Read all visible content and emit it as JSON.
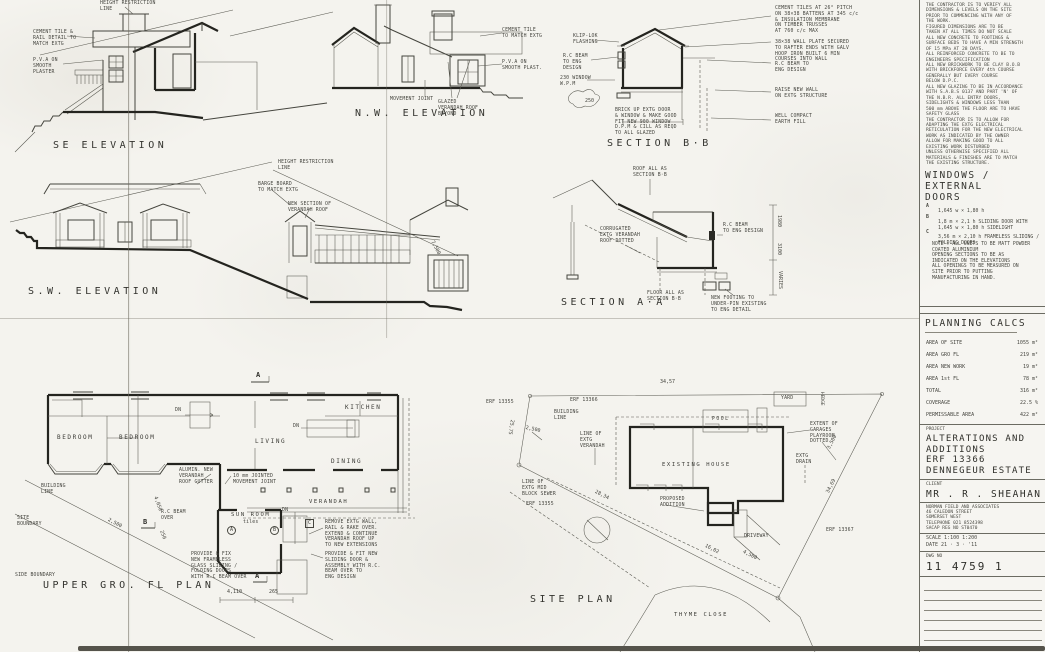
{
  "sheet": {
    "paper": "#f4f3ee",
    "ink": "#45453f"
  },
  "titleblock": {
    "notes": "THE CONTRACTOR IS TO VERIFY ALL\nDIMENSIONS & LEVELS ON THE SITE\nPRIOR TO COMMENCING WITH ANY OF\nTHE WORK.\nFIGURED DIMENSIONS ARE TO BE\nTAKEN AT ALL TIMES  DO NOT SCALE\nALL NEW CONCRETE TO FOOTINGS &\nSURFACE BEDS TO HAVE A MIN STRENGTH\nOF 15 MPa AT 28 DAYS.\nALL REINFORCED CONCRETE TO BE TO\nENGINEERS SPECIFICATION\nALL NEW BRICKWORK TO BE CLAY B.O.B\nWITH BRICKFORCE EVERY 4th COURSE\nGENERALLY BUT EVERY COURSE\nBELOW D.P.C.\nALL NEW GLAZING TO BE IN ACCORDANCE\nWITH S.A.B.S 0137 AND PART 'N' OF\nTHE N.B.R.  ALL ENTRY DOORS,\nSIDELIGHTS & WINDOWS LESS THAN\n500 mm ABOVE THE FLOOR ARE TO HAVE\nSAFETY GLASS\nTHE CONTRACTOR IS TO ALLOW FOR\nADAPTING THE EXTG ELECTRICAL\nRETICULATION FOR THE NEW ELECTRICAL\nWORK AS INDICATED BY THE OWNER\nALLOW FOR MAKING GOOD TO ALL\nEXISTING WORK DISTURBED\nUNLESS OTHERWISE SPECIFIED ALL\nMATERIALS & FINISHES ARE TO MATCH\nTHE EXISTING STRUCTURE.",
    "windows": {
      "title": "WINDOWS / EXTERNAL\nDOORS",
      "items": [
        {
          "key": "A",
          "text": "1,645 w × 1,80 h"
        },
        {
          "key": "B",
          "text": "1,8 m × 2,1 h SLIDING DOOR WITH\n1,645 w × 1,80 h SIDELIGHT"
        },
        {
          "key": "C",
          "text": "3,56 m × 2,10 h FRAMELESS SLIDING /\nFOLDING DOORS"
        }
      ],
      "note": "NOTE : ALL UNITS TO BE MATT POWDER\nCOATED ALUMINIUM\nOPENING SECTIONS TO BE AS\nINDICATED ON THE ELEVATIONS\nALL OPENINGS TO BE MEASURED ON\nSITE PRIOR TO PUTTING\nMANUFACTURING IN HAND."
    },
    "planning": {
      "title": "PLANNING  CALCS",
      "rows": [
        [
          "AREA OF SITE",
          "1055 m²"
        ],
        [
          "AREA GRO FL",
          "219 m²"
        ],
        [
          "AREA NEW WORK",
          "19 m²"
        ],
        [
          "AREA 1st FL",
          "78 m²"
        ],
        [
          "TOTAL",
          "316 m²"
        ],
        [
          "COVERAGE",
          "22.5 %"
        ],
        [
          "PERMISSABLE AREA",
          "422 m²"
        ]
      ]
    },
    "project": {
      "label": "PROJECT",
      "name": "ALTERATIONS  AND\nADDITIONS\nERF  13366\nDENNEGEUR  ESTATE",
      "client_label": "CLIENT",
      "client": "MR . R . SHEAHAN",
      "firm": "NORMAN FIELD AND ASSOCIATES\n46 CALEDON STREET\nSOMERSET WEST\nTELEPHONE 021 8524398\nSACAP REG NO ST0470",
      "scale": "SCALE   1:100    1:200",
      "date": "DATE    21 · 3 · '11",
      "dwg_label": "DWG NO",
      "dwg_no": "11  4759 1"
    }
  },
  "se": {
    "label": "SE  ELEVATION",
    "height_note": "HEIGHT  RESTRICTION\nLINE",
    "tile_note": "CEMENT TILE &\nRAIL DETAIL TO\nMATCH EXTG",
    "plaster_note": "P.V.A ON\nSMOOTH\nPLASTER"
  },
  "nw": {
    "label": "N.W.  ELEVATION",
    "tile_note": "CEMENT TILE\nTO MATCH EXTG",
    "plaster_note": "P.V.A ON\nSMOOTH PLAST.",
    "joint_note": "MOVEMENT  JOINT",
    "verandah_note": "GLAZED\nVERANDAH ROOF\nBEYOND"
  },
  "sbb": {
    "label": "SECTION  B·B",
    "flashing": "KLIP-LOK\nFLASHING",
    "beam": "R.C BEAM\nTO ENG\nDESIGN",
    "window": "230 WINDOW\nW.P.M",
    "ground": "250",
    "brick": "BRICK UP EXTG DOOR\n& WINDOW & MAKE GOOD\nFIT NEW 900 WINDOW\nD.P.M & CILL AS REQD\nTO ALL GLAZED",
    "tiles": "CEMENT TILES AT 26° PITCH\nON 38×38 BATTENS AT 345 c/c\n& INSULATION MEMBRANE\nON TIMBER TRUSSES\nAT 760 c/c MAX",
    "plate": "38×38 WALL PLATE SECURED\nTO RAFTER ENDS WITH GALV\nHOOP IRON BUILT 6 MIN\nCOURSES INTO WALL",
    "beam2": "R.C BEAM TO\nENG DESIGN",
    "raise": "RAISE NEW WALL\nON EXTG STRUCTURE",
    "compact": "WELL COMPACT\nEARTH FILL"
  },
  "sw": {
    "label": "S.W.  ELEVATION",
    "height_note": "HEIGHT RESTRICTION\nLINE",
    "barge": "BARGE BOARD\nTO MATCH EXTG",
    "new_section": "NEW SECTION OF\nVERANDAH ROOF",
    "d7500": "7,500"
  },
  "saa": {
    "label": "SECTION  A·A",
    "roof_as": "ROOF ALL AS\nSECTION B·B",
    "corr": "CORRUGATED\nEXTG VERANDAH\nROOF DOTTED",
    "beam": "R.C BEAM\nTO ENG DESIGN",
    "floor_as": "FLOOR ALL AS\nSECTION B·B",
    "footing": "NEW FOOTING TO\nUNDER-PIN EXISTING\nTO ENG DETAIL",
    "d1980": "1980",
    "d3100": "3100",
    "varies": "VARIES"
  },
  "plan": {
    "label": "UPPER  GRO.  FL  PLAN",
    "bedroom": "BEDROOM",
    "living": "LIVING",
    "kitchen": "KITCHEN",
    "dining": "DINING",
    "verandah": "VERANDAH",
    "sunroom": "SUN ROOM",
    "tiles": "tiles",
    "dn": "DN",
    "joint": "10 mm JOINTED\nMOVEMENT JOINT",
    "gutter": "ALUMIN. NEW\nVERANDAH\nROOF GUTTER",
    "remove": "REMOVE EXTG WALL,\nRAIL & RAKE OVER.\nEXTEND & CONTINUE\nVERANDAH ROOF UP\nTO NEW EXTENSIONS",
    "sliding": "PROVIDE & FIT NEW\nSLIDING DOOR &\nASSEMBLY WITH R.C.\nBEAM OVER TO\nENG DESIGN",
    "frameless": "PROVIDE & FIX\nNEW FRAMELESS\nGLASS SLIDING /\nFOLDING DOORS\nWITH R.C BEAM OVER",
    "beam_over": "R.C BEAM\nOVER",
    "site_boundary": "SITE\nBOUNDARY",
    "side_boundary": "SIDE BOUNDARY",
    "building_line": "BUILDING\nLINE",
    "marker_a": "A",
    "marker_b": "B",
    "marker_c": "C",
    "d2500": "2,500",
    "d4050": "4,050",
    "d250": "250",
    "d4110": "4,110",
    "d265": "265"
  },
  "site": {
    "label": "SITE  PLAN",
    "erf_site": "ERF 13366",
    "erf_left": "ERF 13355",
    "erf_right": "ERF 13367",
    "existing": "EXISTING  HOUSE",
    "addition": "PROPOSED\nADDITION",
    "pool": "POOL",
    "yard": "YARD",
    "driveway": "DRIVEWAY",
    "street": "THYME  CLOSE",
    "building_line": "BUILDING\nLINE",
    "hedge": "HEDGE",
    "extent": "EXTENT OF\nGARAGES\nPLAYROOM\nDOTTED",
    "drain": "EXTG\nDRAIN",
    "verandah_line": "LINE OF\nEXTG\nVERANDAH",
    "sewer": "LINE OF\nEXTG MID\nBLOCK SEWER",
    "d3457": "34,57",
    "d2575": "25,75",
    "d2500": "2,500",
    "d2834": "28,34",
    "d1602": "16,02",
    "d4500": "4,500",
    "d3469": "34,69",
    "d3500": "3,500"
  }
}
